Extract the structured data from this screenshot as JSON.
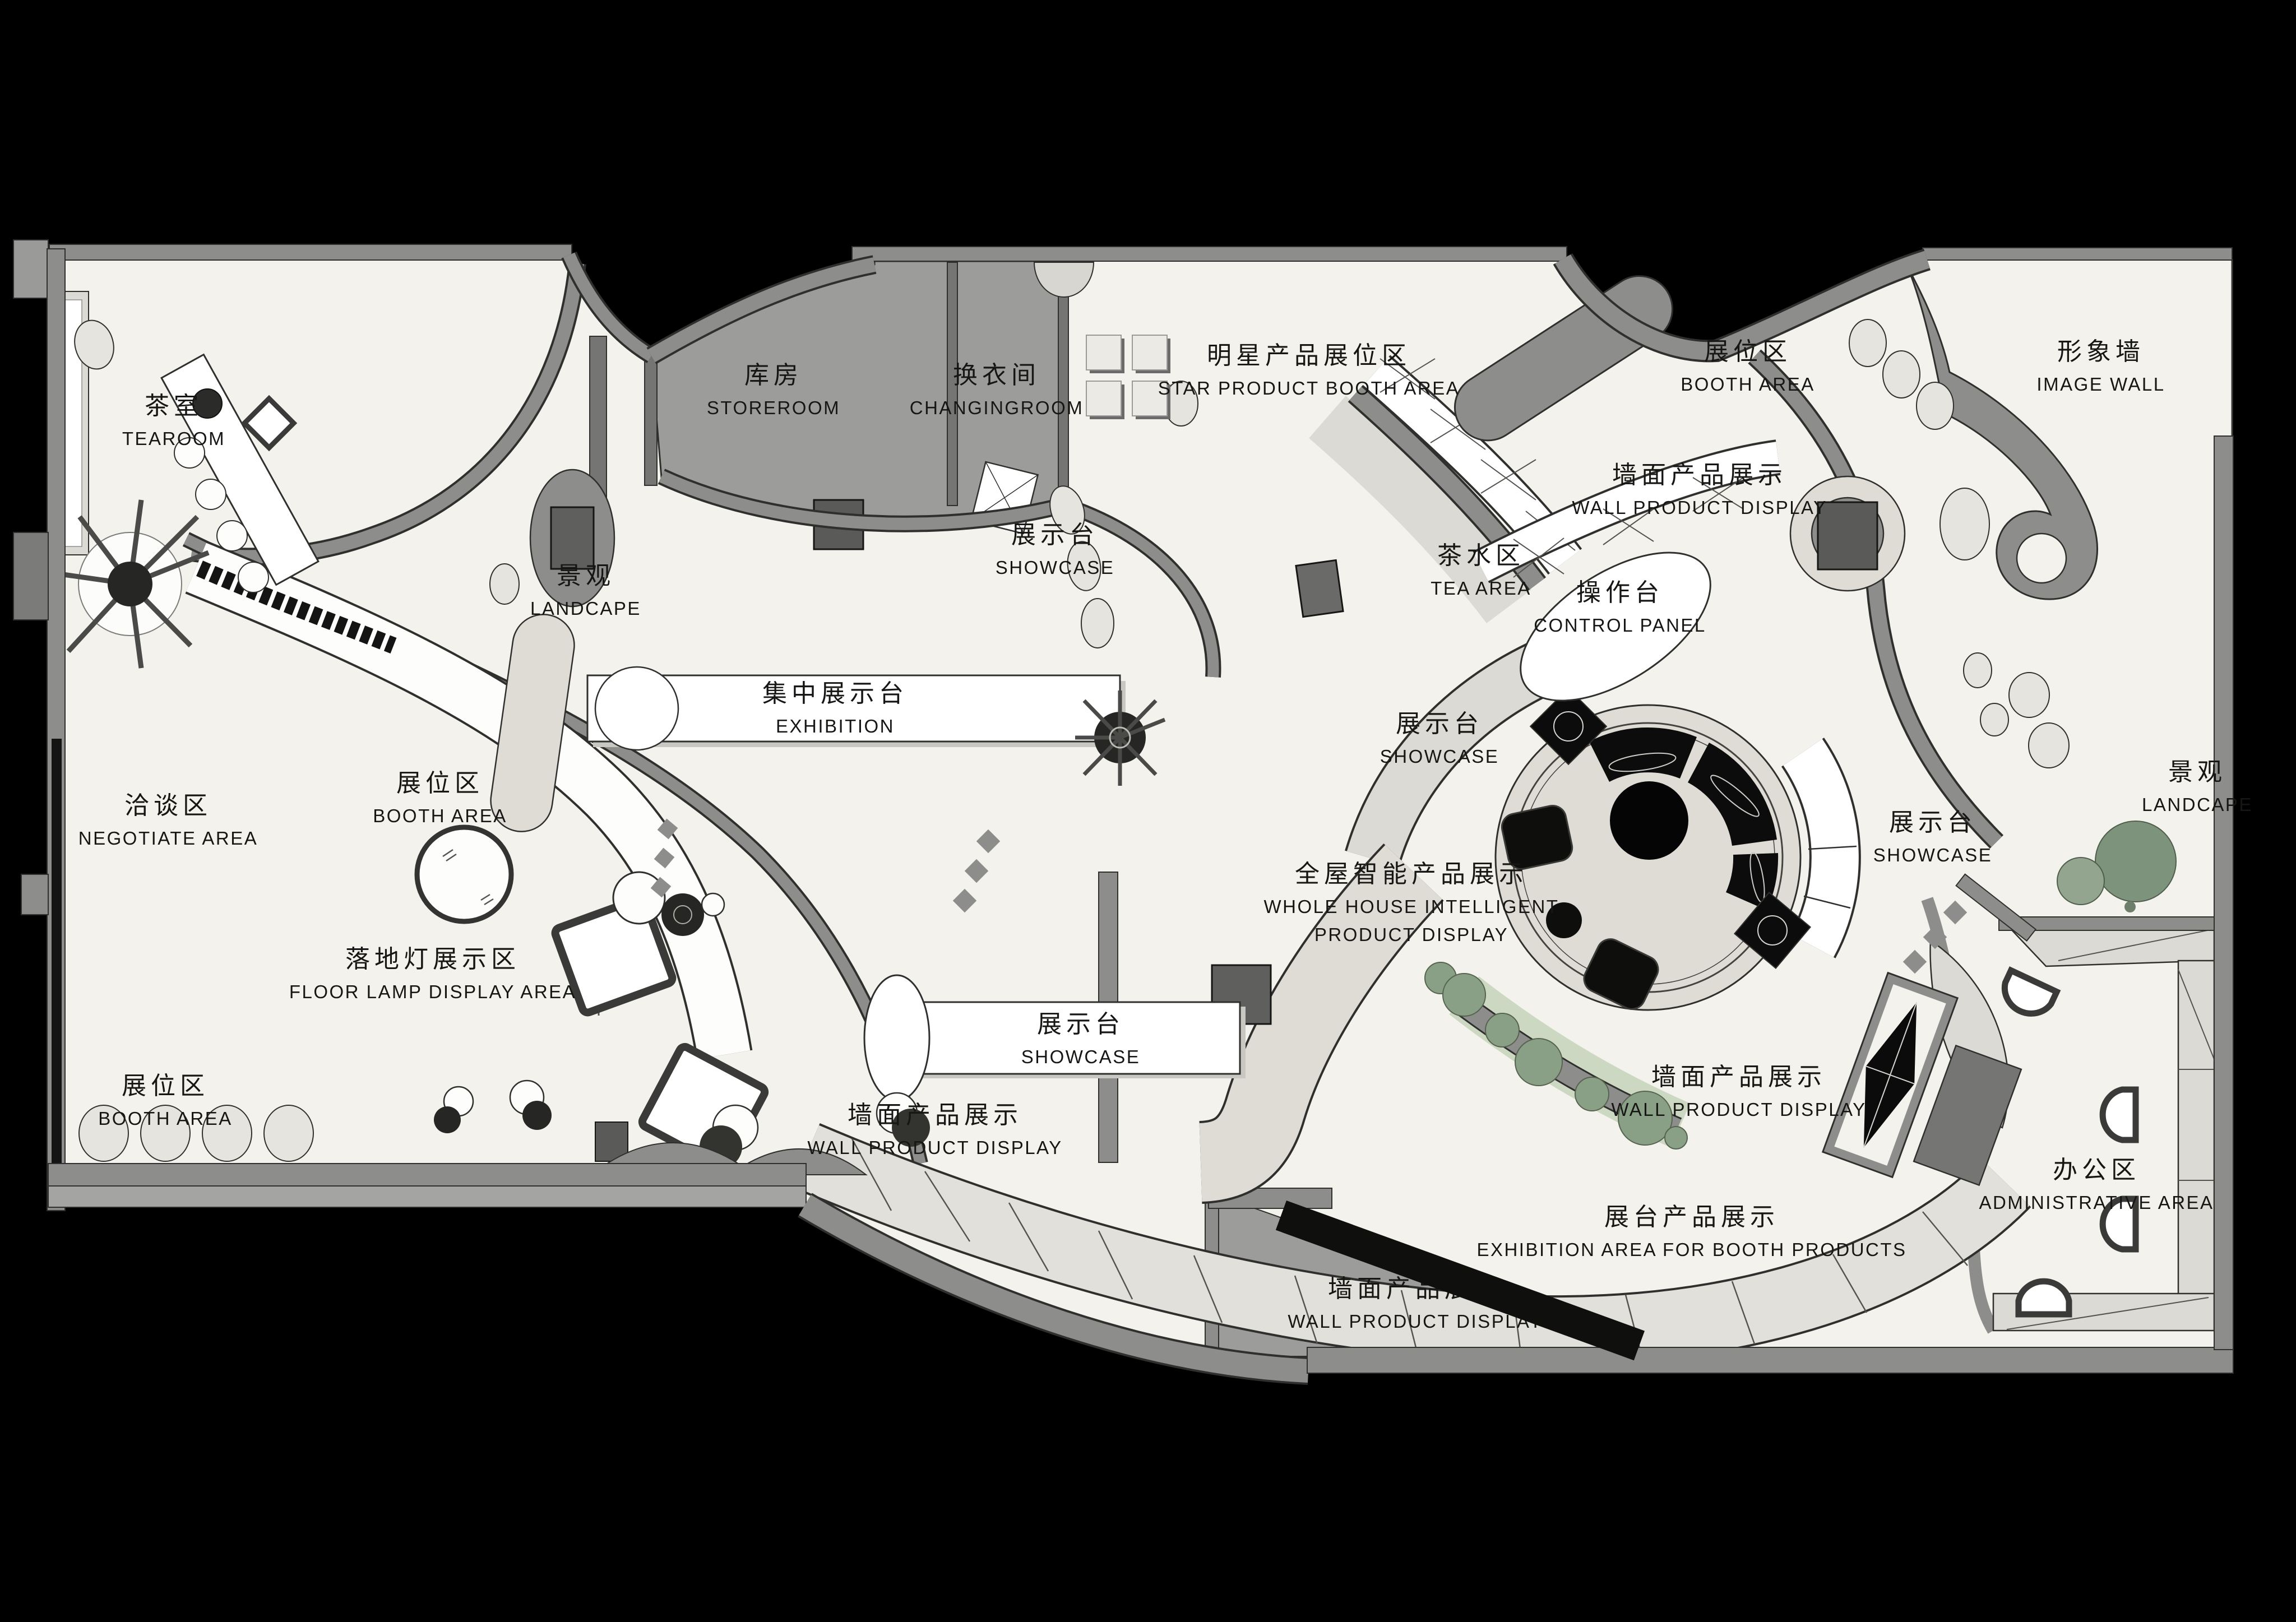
{
  "title": "智能家居展厅平面图 (Smart-home showroom floor plan)",
  "colors": {
    "background": "#000000",
    "floor": "#f4f2ec",
    "wall_gray": "#8d8d8b",
    "room_gray": "#9c9c9a",
    "light_band": "#dedcd5",
    "white": "#ffffff",
    "furniture_black": "#0c0c0c",
    "plant_green": "#8aa086",
    "pale_green": "#ccd8c1"
  },
  "labels": {
    "tearoom": {
      "zh": "茶室",
      "en": "TEAROOM"
    },
    "storeroom": {
      "zh": "库房",
      "en": "STOREROOM"
    },
    "changingroom": {
      "zh": "换衣间",
      "en": "CHANGINGROOM"
    },
    "star_product_booth_area": {
      "zh": "明星产品展位区",
      "en": "STAR PRODUCT BOOTH AREA"
    },
    "booth_area_top": {
      "zh": "展位区",
      "en": "BOOTH AREA"
    },
    "image_wall": {
      "zh": "形象墙",
      "en": "IMAGE WALL"
    },
    "wall_product_display_top": {
      "zh": "墙面产品展示",
      "en": "WALL PRODUCT DISPLAY"
    },
    "landscape_left": {
      "zh": "景观",
      "en": "LANDCAPE"
    },
    "showcase_left": {
      "zh": "展示台",
      "en": "SHOWCASE"
    },
    "tea_area": {
      "zh": "茶水区",
      "en": "TEA AREA"
    },
    "control_panel": {
      "zh": "操作台",
      "en": "CONTROL PANEL"
    },
    "exhibition": {
      "zh": "集中展示台",
      "en": "EXHIBITION"
    },
    "showcase_mid": {
      "zh": "展示台",
      "en": "SHOWCASE"
    },
    "showcase_right": {
      "zh": "展示台",
      "en": "SHOWCASE"
    },
    "landscape_right": {
      "zh": "景观",
      "en": "LANDCAPE"
    },
    "negotiate_area": {
      "zh": "洽谈区",
      "en": "NEGOTIATE AREA"
    },
    "booth_area_left": {
      "zh": "展位区",
      "en": "BOOTH AREA"
    },
    "whole_house": {
      "zh": "全屋智能产品展示",
      "en": "WHOLE HOUSE INTELLIGENT",
      "en2": "PRODUCT DISPLAY"
    },
    "floor_lamp_display_area": {
      "zh": "落地灯展示区",
      "en": "FLOOR LAMP DISPLAY AREA"
    },
    "showcase_bottom": {
      "zh": "展示台",
      "en": "SHOWCASE"
    },
    "booth_area_bottom_left": {
      "zh": "展位区",
      "en": "BOOTH AREA"
    },
    "wall_product_display_bottom_left": {
      "zh": "墙面产品展示",
      "en": "WALL PRODUCT DISPLAY"
    },
    "wall_product_display_right": {
      "zh": "墙面产品展示",
      "en": "WALL PRODUCT DISPLAY"
    },
    "administrative_area": {
      "zh": "办公区",
      "en": "ADMINISTRATIVE AREA"
    },
    "exhibition_booth_products": {
      "zh": "展台产品展示",
      "en": "EXHIBITION AREA FOR BOOTH PRODUCTS"
    },
    "wall_product_display_bottom_center": {
      "zh": "墙面产品展示",
      "en": "WALL PRODUCT DISPLAY"
    }
  }
}
